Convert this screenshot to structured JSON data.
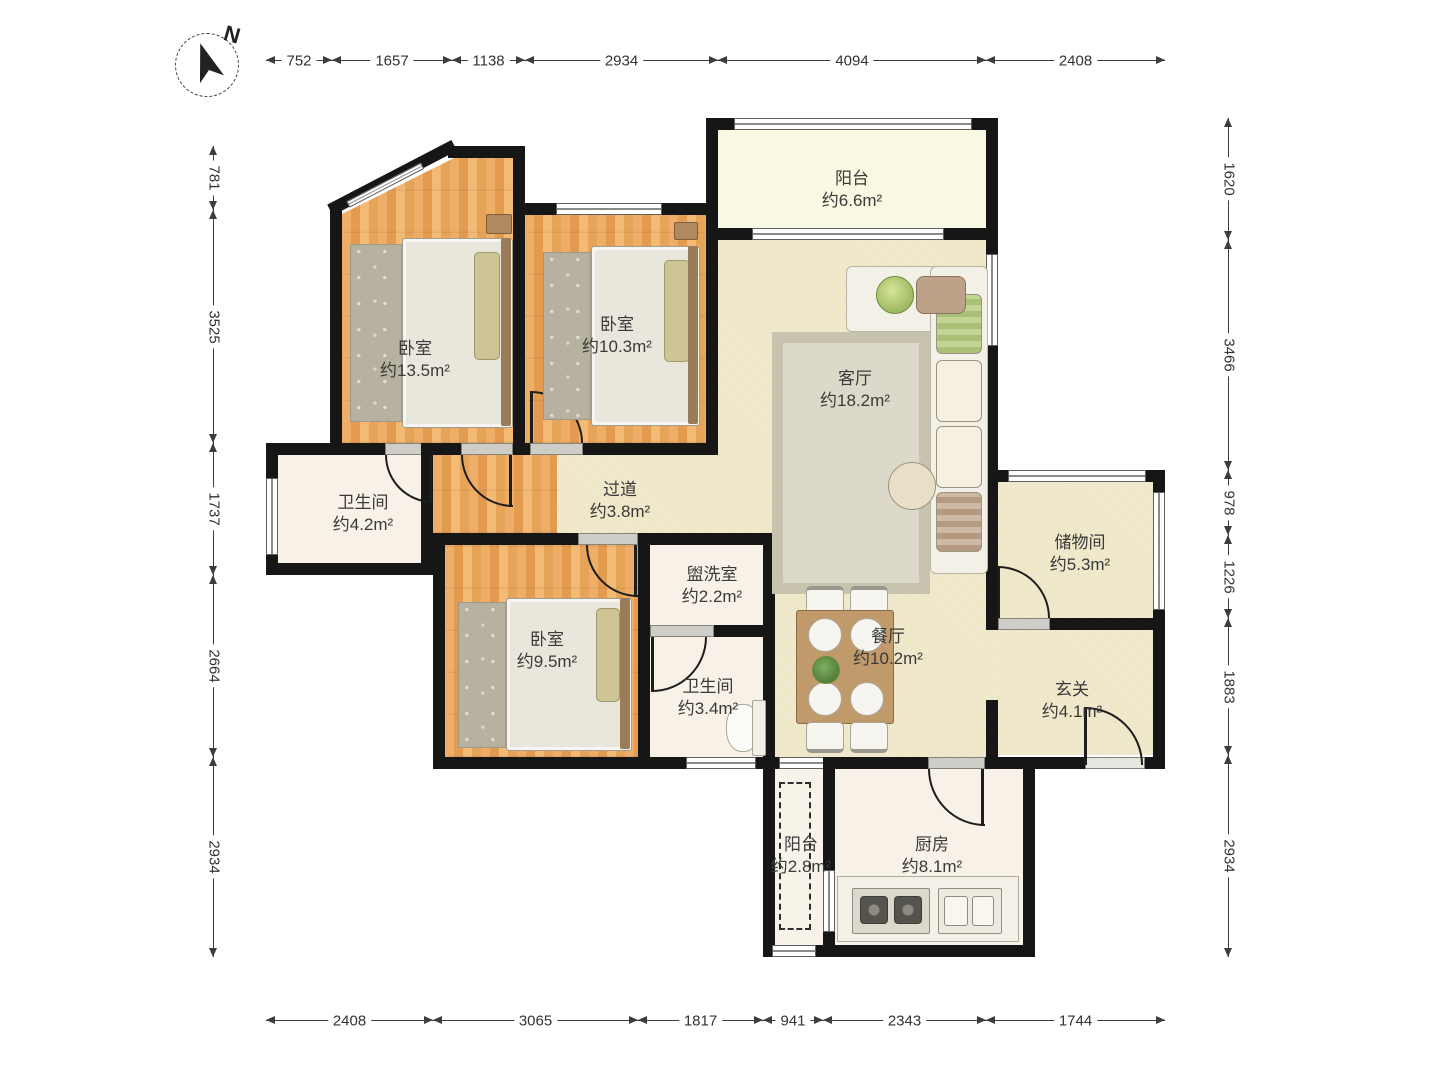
{
  "compass": {
    "north_label": "N"
  },
  "rooms": [
    {
      "name": "阳台",
      "area": "约6.6m²"
    },
    {
      "name": "卧室",
      "area": "约13.5m²"
    },
    {
      "name": "卧室",
      "area": "约10.3m²"
    },
    {
      "name": "客厅",
      "area": "约18.2m²"
    },
    {
      "name": "卫生间",
      "area": "约4.2m²"
    },
    {
      "name": "过道",
      "area": "约3.8m²"
    },
    {
      "name": "储物间",
      "area": "约5.3m²"
    },
    {
      "name": "卧室",
      "area": "约9.5m²"
    },
    {
      "name": "盥洗室",
      "area": "约2.2m²"
    },
    {
      "name": "餐厅",
      "area": "约10.2m²"
    },
    {
      "name": "卫生间",
      "area": "约3.4m²"
    },
    {
      "name": "玄关",
      "area": "约4.1m²"
    },
    {
      "name": "阳台",
      "area": "约2.8m²"
    },
    {
      "name": "厨房",
      "area": "约8.1m²"
    }
  ],
  "dimensions": {
    "top": [
      "752",
      "1657",
      "1138",
      "2934",
      "4094",
      "2408"
    ],
    "left": [
      "781",
      "3525",
      "1737",
      "2664",
      "2934"
    ],
    "right": [
      "1620",
      "3466",
      "978",
      "1226",
      "1883",
      "2934"
    ],
    "bottom": [
      "2408",
      "3065",
      "1817",
      "941",
      "2343",
      "1744"
    ]
  },
  "colors": {
    "wall": "#161616",
    "wood_floor": "#e8a55d",
    "tile_floor": "#eee7c8",
    "wet_room_floor": "#f8f1e7",
    "balcony_floor": "#f9f8e2"
  }
}
